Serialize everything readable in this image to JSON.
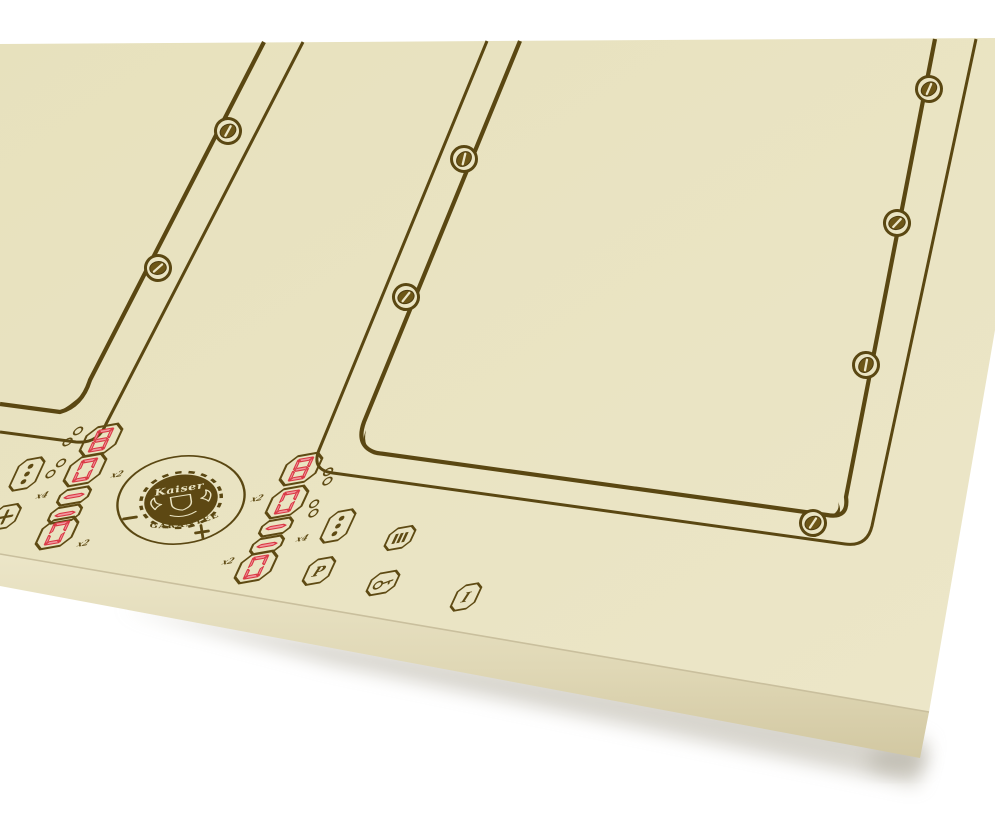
{
  "logo": {
    "brand": "Kaiser",
    "arc_text": "GARANTEE"
  },
  "controls": {
    "left_zone": {
      "displays": [
        {
          "value": "8"
        },
        {
          "value": "0",
          "multiplier": "x2"
        },
        {
          "value": "-",
          "multiplier": "x4"
        },
        {
          "value": "-"
        },
        {
          "value": "0",
          "multiplier": "x2"
        }
      ],
      "plus_label": "+"
    },
    "center_zone": {
      "displays": [
        {
          "value": "8"
        },
        {
          "value": "0",
          "multiplier": "x2"
        },
        {
          "value": "-",
          "multiplier": "x4"
        },
        {
          "value": "-"
        },
        {
          "value": "0",
          "multiplier": "x2"
        }
      ],
      "boost_label": "P",
      "power_label": "I"
    },
    "slider": {
      "minus_label": "–",
      "plus_label": "+"
    }
  },
  "colors": {
    "background": "#ffffff",
    "glass": "#eae4c3",
    "side_face": "#ddd4b2",
    "ornament_line": "#5a4712",
    "digit_fill": "#f2969e",
    "digit_edge": "#d93844"
  }
}
